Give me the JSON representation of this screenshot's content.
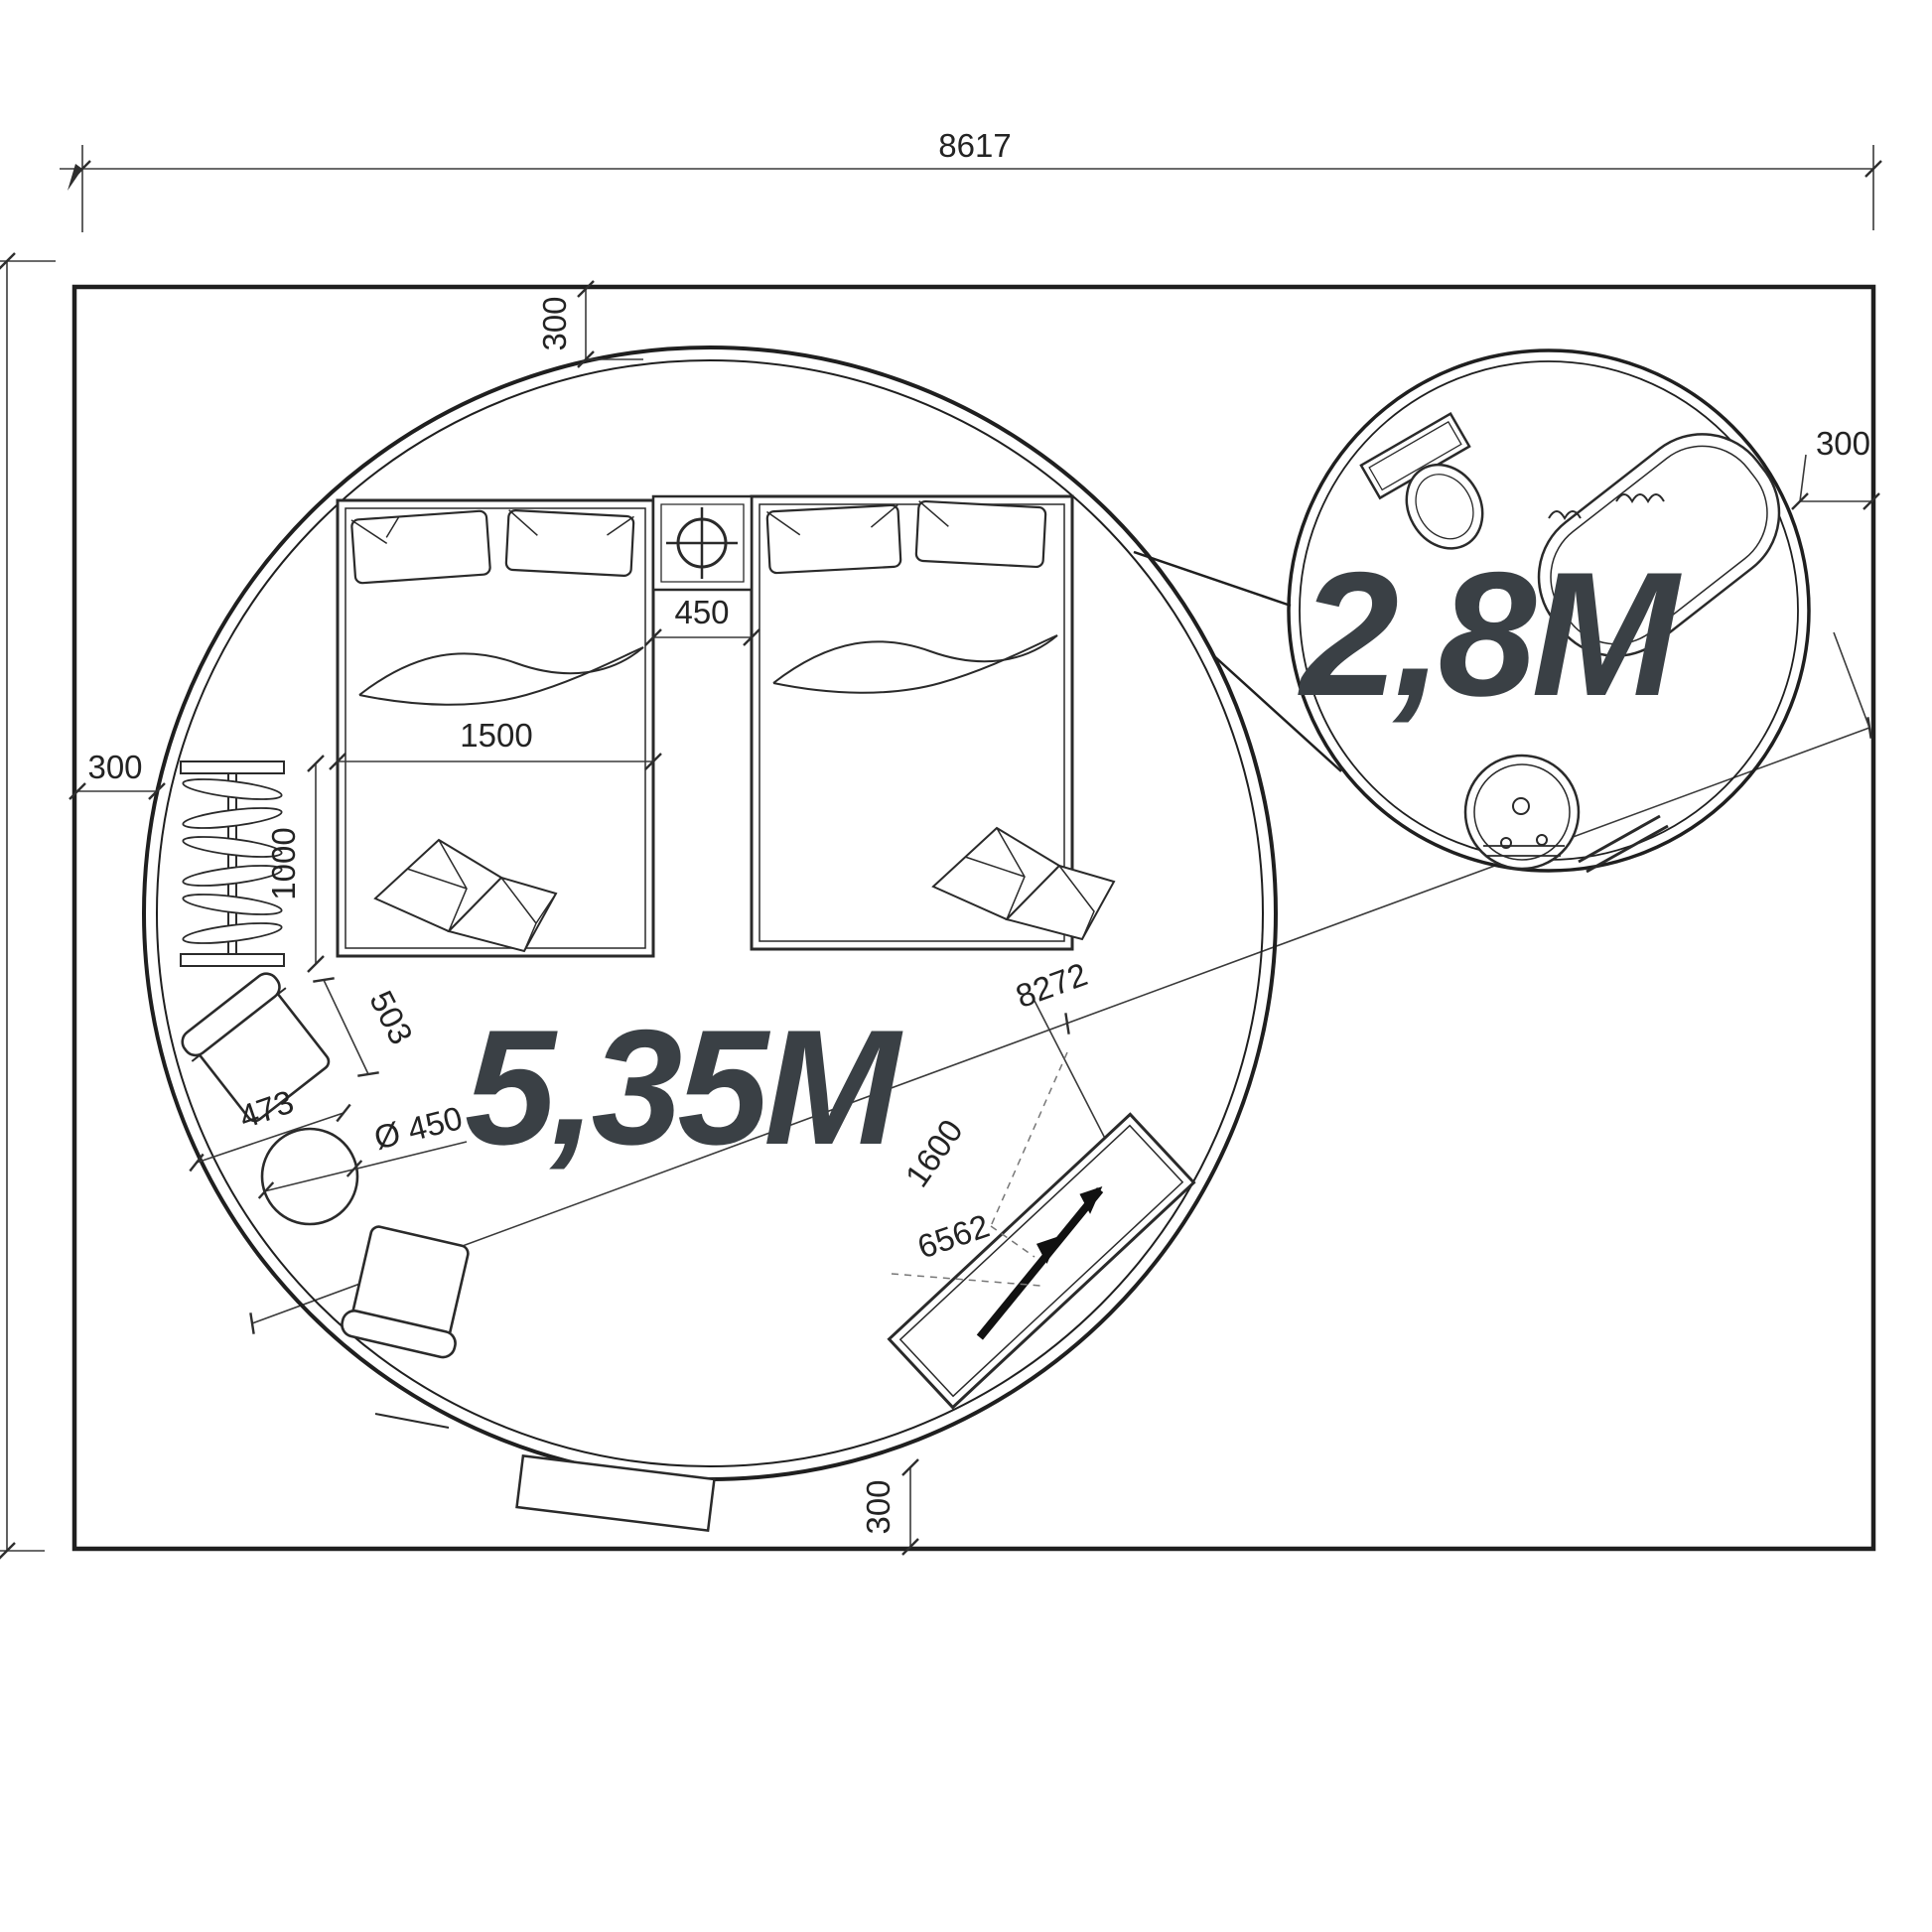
{
  "labels": {
    "site_width": "8617",
    "offset_top": "300",
    "offset_left": "300",
    "offset_right": "300",
    "offset_bottom": "300",
    "bed_width": "1500",
    "radiator_length": "1000",
    "bed_gap": "450",
    "armchair_depth": "503",
    "armchair_width": "473",
    "table_diameter": "Ø 450",
    "diagonal_total": "8272",
    "bench_length": "1600",
    "diagonal_partial": "6562",
    "large_yurt_diameter": "5,35M",
    "small_yurt_diameter": "2,8M"
  },
  "colors": {
    "outline": "#1f1f1f",
    "dimension_text": "#232323",
    "big_label_text": "#3a4045",
    "background": "#ffffff"
  }
}
